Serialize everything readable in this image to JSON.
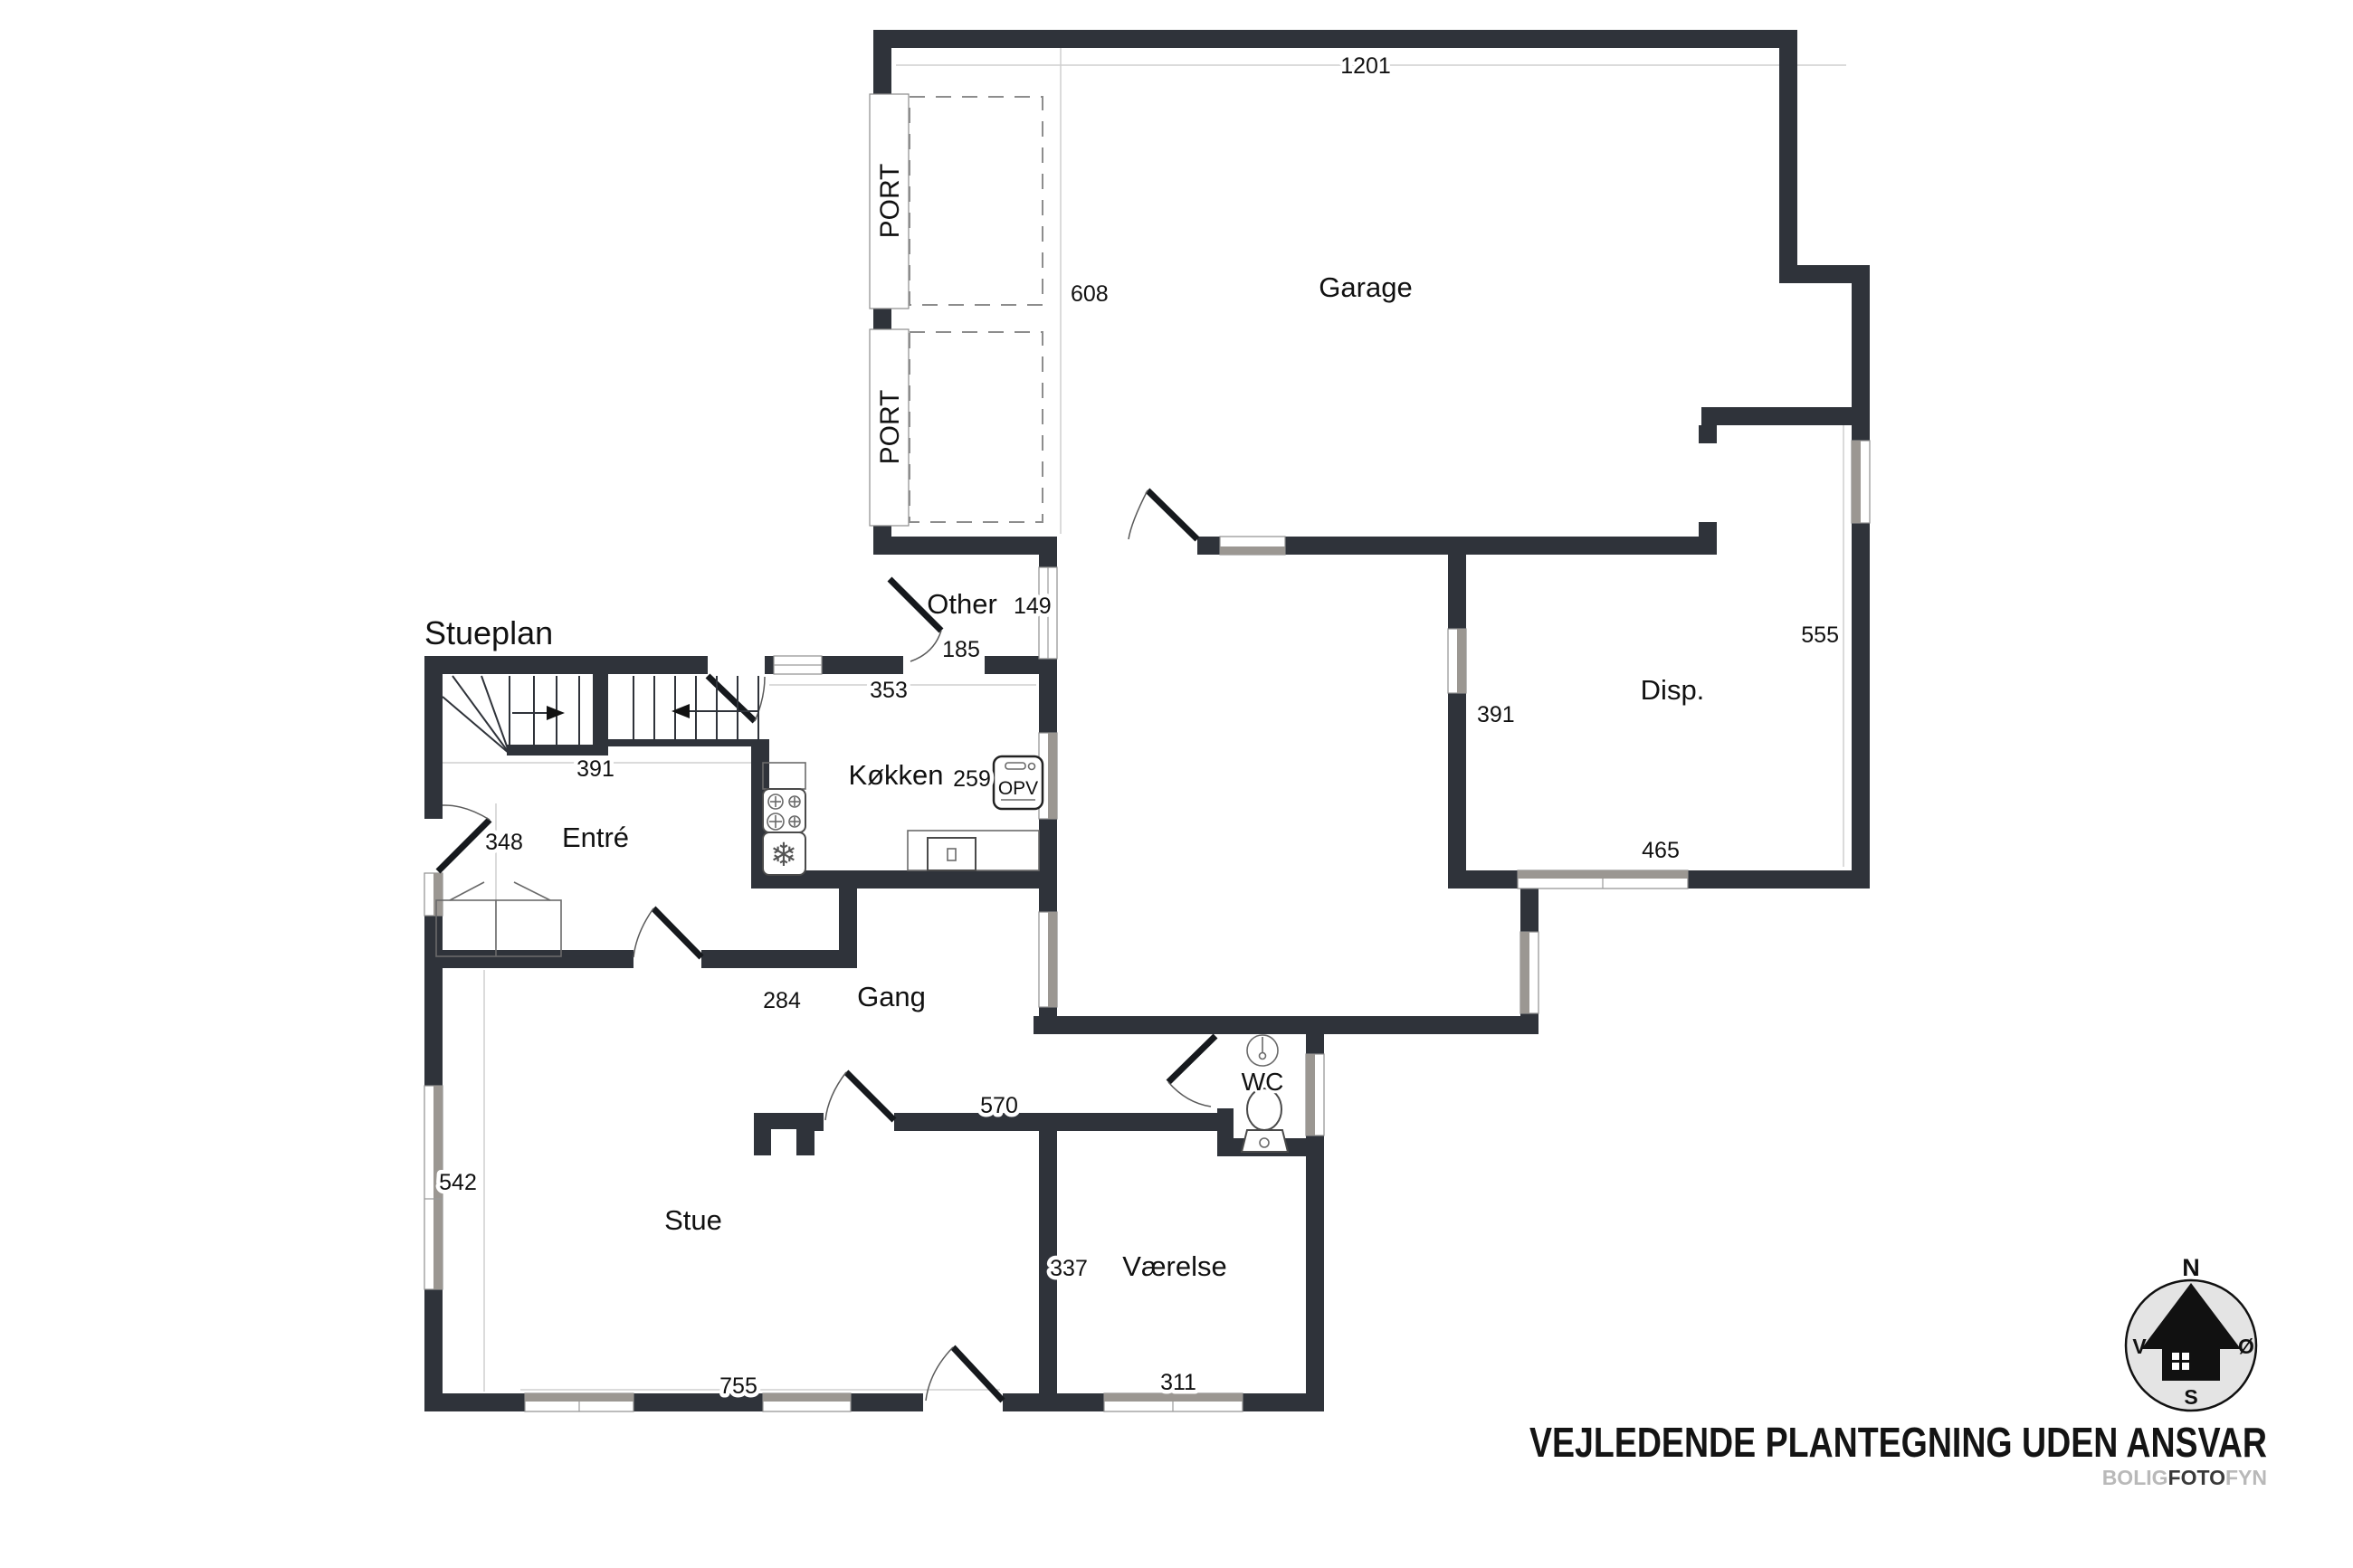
{
  "title": "Stueplan",
  "rooms": {
    "garage": "Garage",
    "disp": "Disp.",
    "other": "Other",
    "kokken": "Køkken",
    "entre": "Entré",
    "gang": "Gang",
    "stue": "Stue",
    "vaerelse": "Værelse",
    "wc": "WC"
  },
  "dims": {
    "garage_width": "1201",
    "garage_depth": "608",
    "disp_right": "555",
    "disp_left": "391",
    "disp_bottom": "465",
    "other": "149",
    "other_b": "185",
    "kokken_top": "353",
    "kokken": "259",
    "stair": "391",
    "entre": "348",
    "gang": "284",
    "gang_b": "570",
    "stue_left": "542",
    "stue_bottom": "755",
    "vaerelse": "337",
    "vaerelse_bottom": "311"
  },
  "labels": {
    "port_upper": "PORT",
    "port_lower": "PORT",
    "opv": "OPV"
  },
  "compass": {
    "north": "N",
    "south": "S",
    "west": "V",
    "east": "Ø"
  },
  "footer": {
    "disclaimer": "VEJLEDENDE PLANTEGNING UDEN ANSVAR",
    "brand": {
      "bolig": "BOLIG",
      "foto": "FOTO",
      "fyn": "FYN"
    }
  },
  "colors": {
    "wall": "#2f333a",
    "window_gray": "#9b9792",
    "dim_line": "#cfcfcf",
    "compass_bg": "#e4e4e4",
    "brand_gray": "#b9b9b9",
    "brand_dark": "#3a3a3a"
  }
}
